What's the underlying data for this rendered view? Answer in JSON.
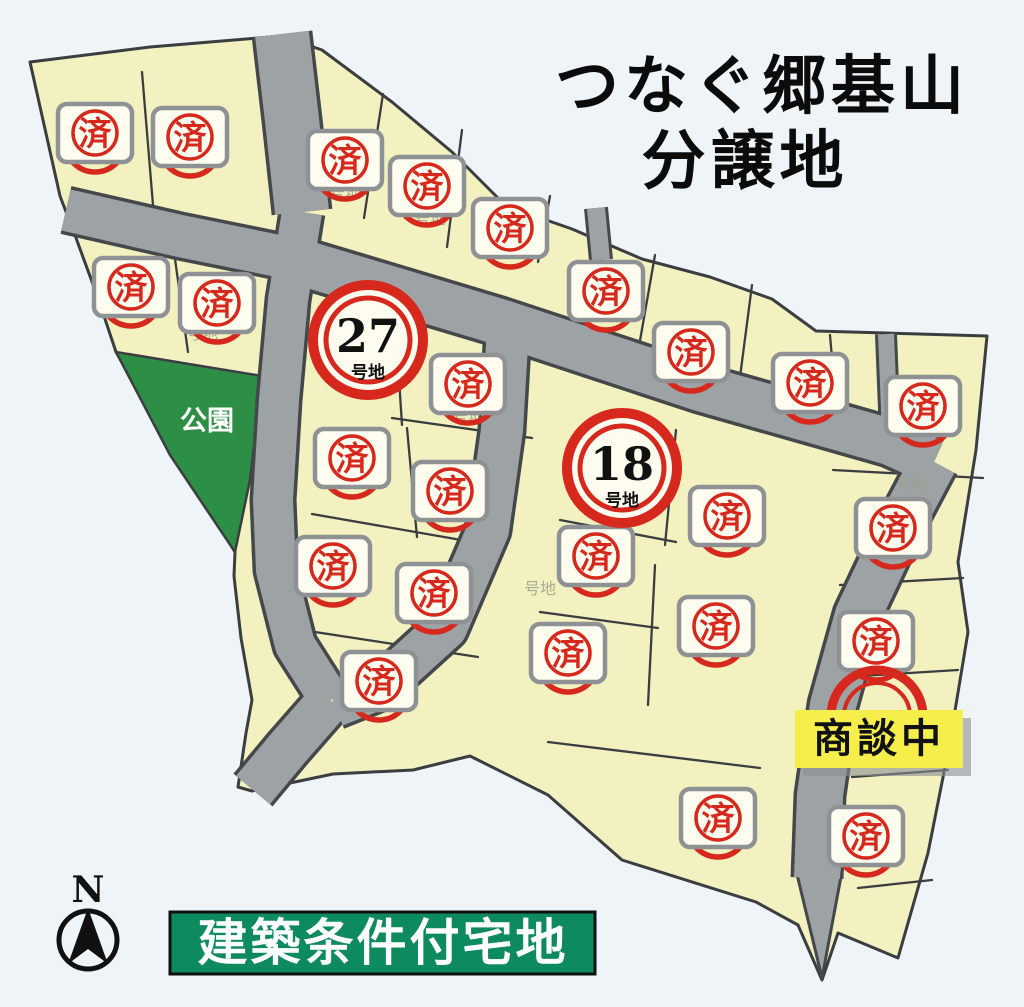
{
  "header": {
    "title_line1": "つなぐ郷基山",
    "title_line2": "分譲地"
  },
  "footer": {
    "banner_text": "建築条件付宅地"
  },
  "map": {
    "park_label": "公園",
    "compass_label": "N",
    "negotiating_label": "商談中",
    "sold_stamp_char": "済",
    "lot_suffix": "号地",
    "available_lots": [
      {
        "number": "27",
        "x": 368,
        "y": 340
      },
      {
        "number": "18",
        "x": 622,
        "y": 468
      }
    ],
    "sold_stamps": [
      [
        95,
        133
      ],
      [
        190,
        137
      ],
      [
        345,
        160
      ],
      [
        427,
        186
      ],
      [
        510,
        228
      ],
      [
        131,
        287
      ],
      [
        217,
        303
      ],
      [
        606,
        291
      ],
      [
        691,
        352
      ],
      [
        810,
        383
      ],
      [
        923,
        406
      ],
      [
        468,
        384
      ],
      [
        352,
        458
      ],
      [
        450,
        491
      ],
      [
        333,
        566
      ],
      [
        434,
        593
      ],
      [
        379,
        681
      ],
      [
        727,
        516
      ],
      [
        596,
        556
      ],
      [
        568,
        653
      ],
      [
        716,
        626
      ],
      [
        718,
        818
      ],
      [
        893,
        528
      ],
      [
        876,
        641
      ],
      [
        866,
        836
      ]
    ],
    "faint_lot_labels": [
      [
        345,
        198
      ],
      [
        430,
        224
      ],
      [
        468,
        422
      ],
      [
        202,
        339
      ],
      [
        540,
        594
      ],
      [
        912,
        490
      ]
    ],
    "colors": {
      "stamp_red": "#d6281c",
      "lot_fill": "#f3f1bf",
      "road_gray": "#9da2a4",
      "park_green": "#2d8f45",
      "banner_green": "#0e8a5f",
      "negotiating_yellow": "#f6ef4b"
    }
  }
}
